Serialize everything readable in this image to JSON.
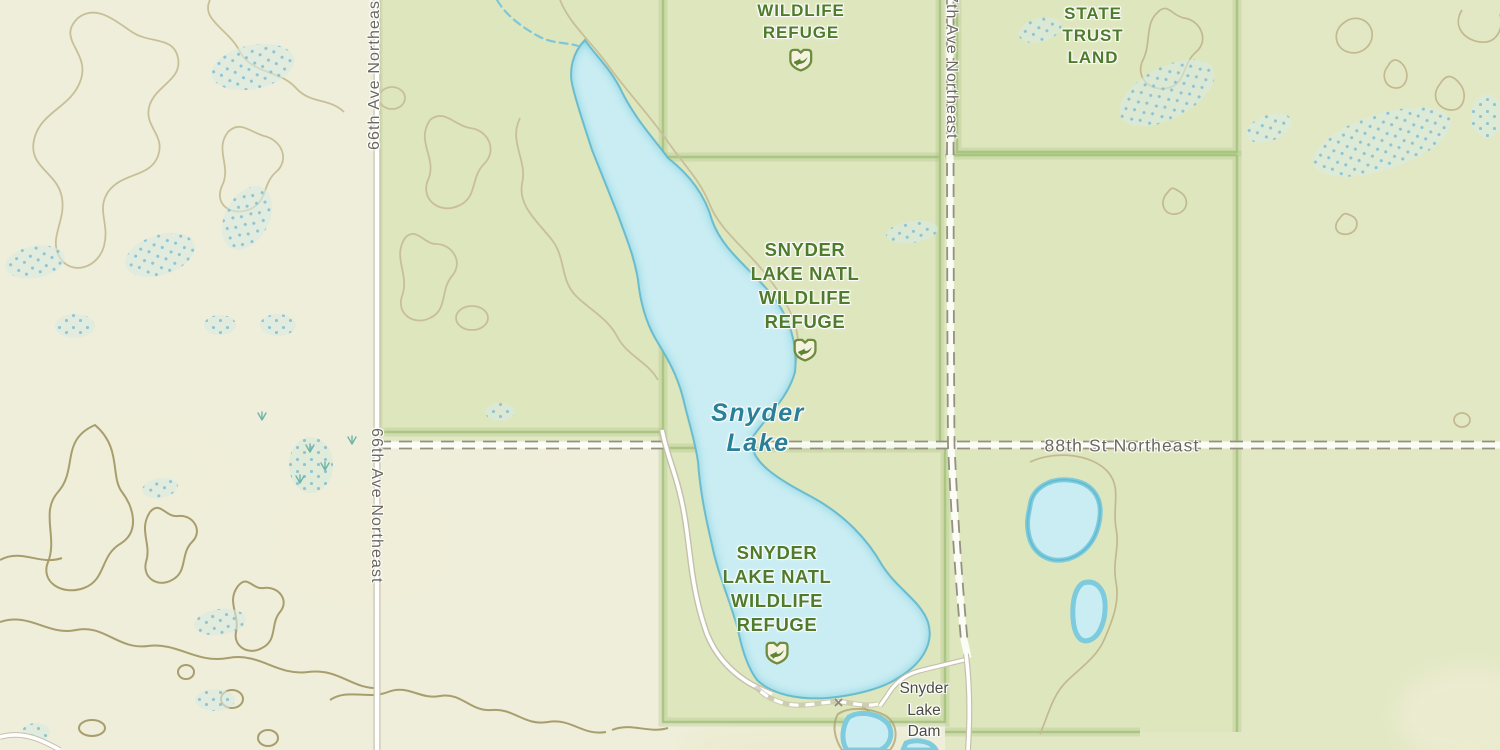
{
  "colors": {
    "pale_land": "#eeeeda",
    "green_land": "#e2e8c4",
    "protected_fill": "#dee6bd",
    "protected_border": "#a3bf79",
    "refuge_label": "#4e7c2c",
    "water_fill": "#c9edf3",
    "water_rim": "#7ecbdd",
    "water_stroke": "#5cb6cd",
    "water_label": "#2a7f99",
    "contour_light": "#c8bf98",
    "contour_dark": "#a89d6c",
    "contour_east": "#c2b98f",
    "marsh_fill": "#d9ebe2",
    "marsh_dot": "#85bfd3",
    "marsh_tuft": "#6fb4a8",
    "road_fill": "#ffffff",
    "road_casing": "#c6c0ab",
    "track_dash": "#95907f",
    "road_label": "#6b675d",
    "poi_label": "#4b4b45",
    "stream": "#7fc6da"
  },
  "labels": {
    "protected_areas": {
      "refuge_top": {
        "lines": [
          "WILDLIFE",
          "REFUGE"
        ]
      },
      "refuge_mid": {
        "lines": [
          "SNYDER",
          "LAKE NATL",
          "WILDLIFE",
          "REFUGE"
        ]
      },
      "refuge_south": {
        "lines": [
          "SNYDER",
          "LAKE NATL",
          "WILDLIFE",
          "REFUGE"
        ]
      },
      "state_trust": {
        "lines": [
          "STATE",
          "TRUST",
          "LAND"
        ]
      }
    },
    "water": {
      "lake": {
        "lines": [
          "Snyder",
          "Lake"
        ]
      }
    },
    "poi": {
      "dam": {
        "lines": [
          "Snyder",
          "Lake",
          "Dam"
        ]
      }
    },
    "roads": {
      "ave66_upper": "66th Ave Northeast",
      "ave66_lower": "66th Ave Northeast",
      "ave67": "67th Ave Northeast",
      "st88": "88th St Northeast"
    }
  },
  "icons": {
    "refuge_badge": "wildlife-refuge-shield-bird"
  }
}
